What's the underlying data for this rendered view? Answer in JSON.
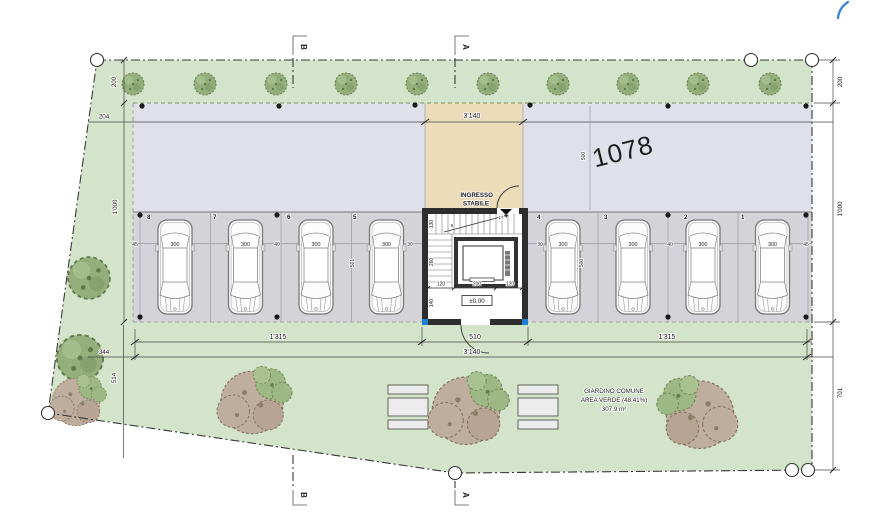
{
  "plan": {
    "parcel": "1078",
    "entrance": {
      "line1": "INGRESSO",
      "line2": "STABILE"
    },
    "level": "±0.00",
    "garden_text": {
      "l1": "GIARDINO COMUNE",
      "l2": "AREA VERDE (48.41%)",
      "l3": "307.9 m²"
    },
    "section_a": "A",
    "section_b": "B",
    "stall_numbers": [
      "8",
      "7",
      "6",
      "5",
      "4",
      "3",
      "2",
      "1"
    ],
    "stall_width": "300",
    "gaps": [
      "45",
      "40",
      "30",
      "30",
      "40",
      "45"
    ],
    "dims": {
      "top_total": "3'140",
      "left_strip": "200",
      "left_offset": "204",
      "left_depth": "1'000",
      "left_w344": "344",
      "left_h514": "514",
      "right_strip": "200",
      "right_depth": "1'000",
      "right_garden": "701",
      "bottom_seg_left": "1'315",
      "bottom_seg_mid": "510",
      "bottom_seg_right": "1'315",
      "bottom_total": "3'140",
      "bay_left": "501",
      "bay_right": "500",
      "plaza_depth": "500",
      "core_rows": [
        "130",
        "260",
        "140"
      ],
      "core_cols": [
        "120",
        "200",
        "120"
      ],
      "stair_mid": "6",
      "stair_top": "17"
    },
    "colors": {
      "site_green": "#d4e4ca",
      "paving": "#e0e0ea",
      "stalls": "#d4d4d8",
      "plaza_tan": "#ecdcba",
      "accent_blue": "#1f7fd4"
    }
  }
}
